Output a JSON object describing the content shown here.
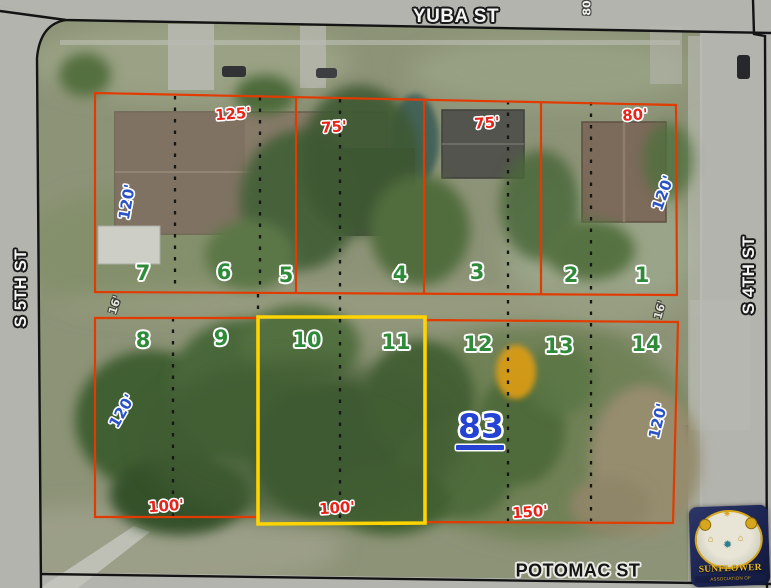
{
  "map_type": "aerial-plat-map",
  "streets": {
    "top": "YUBA ST",
    "left": "S 5TH ST",
    "right": "S 4TH ST",
    "bottom": "POTOMAC ST",
    "top_edge_partial": "80"
  },
  "parcel": {
    "number": "83"
  },
  "lots": {
    "numbers": [
      "7",
      "6",
      "5",
      "4",
      "3",
      "2",
      "1",
      "8",
      "9",
      "10",
      "11",
      "12",
      "13",
      "14"
    ]
  },
  "dimensions": {
    "frontage_top": [
      "125'",
      "75'",
      "75'",
      "80'"
    ],
    "frontage_bottom": [
      "100'",
      "100'",
      "150'"
    ],
    "depths": [
      "120'",
      "120'",
      "120'",
      "120'"
    ],
    "alley_gaps": [
      "16'",
      "16'"
    ]
  },
  "logo": {
    "title": "SUNFLOWER",
    "subtitle": "ASSOCIATION OF REALTORS®"
  },
  "colors": {
    "lot_outline_red": "#e23b00",
    "highlight_yellow": "#ffd400",
    "lot_number_green": "#2f8b3a",
    "dimension_red": "#e8231a",
    "depth_blue": "#2a52c8",
    "parcel_blue": "#2443d2",
    "street_line_black": "#141414"
  }
}
